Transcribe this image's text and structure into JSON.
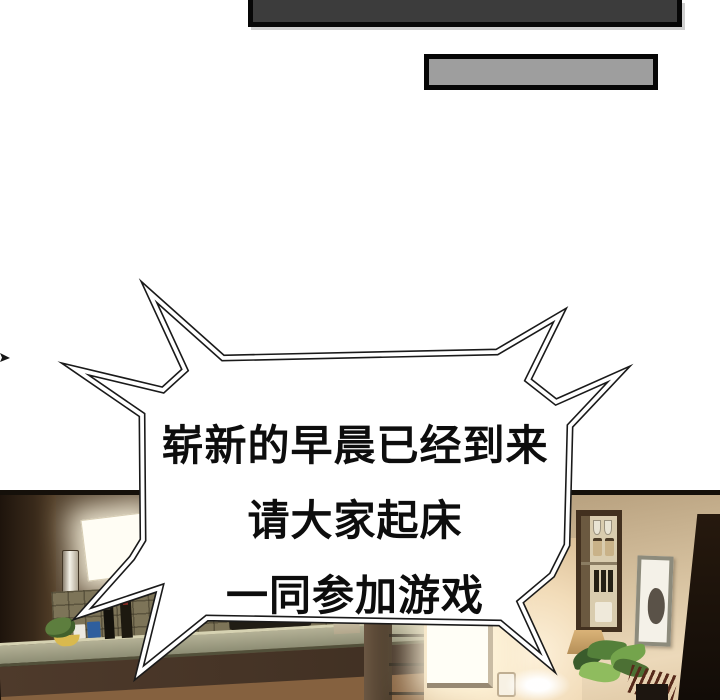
{
  "speech_bubble": {
    "lines": [
      "崭新的早晨已经到来",
      "请大家起床",
      "一同参加游戏"
    ]
  },
  "colors": {
    "background": "#ffffff",
    "bubble_fill": "#ffffff",
    "bubble_outline": "#1a1a1a",
    "text": "#0d0d0d",
    "panel_bar_dark": "#3c3c3c",
    "caption_box_gray": "#9e9e9e",
    "kitchen_wall": "#75614a",
    "living_wall": "#e6d2b2",
    "counter": "#8d8d74",
    "window_glow": "#fffdf4"
  }
}
